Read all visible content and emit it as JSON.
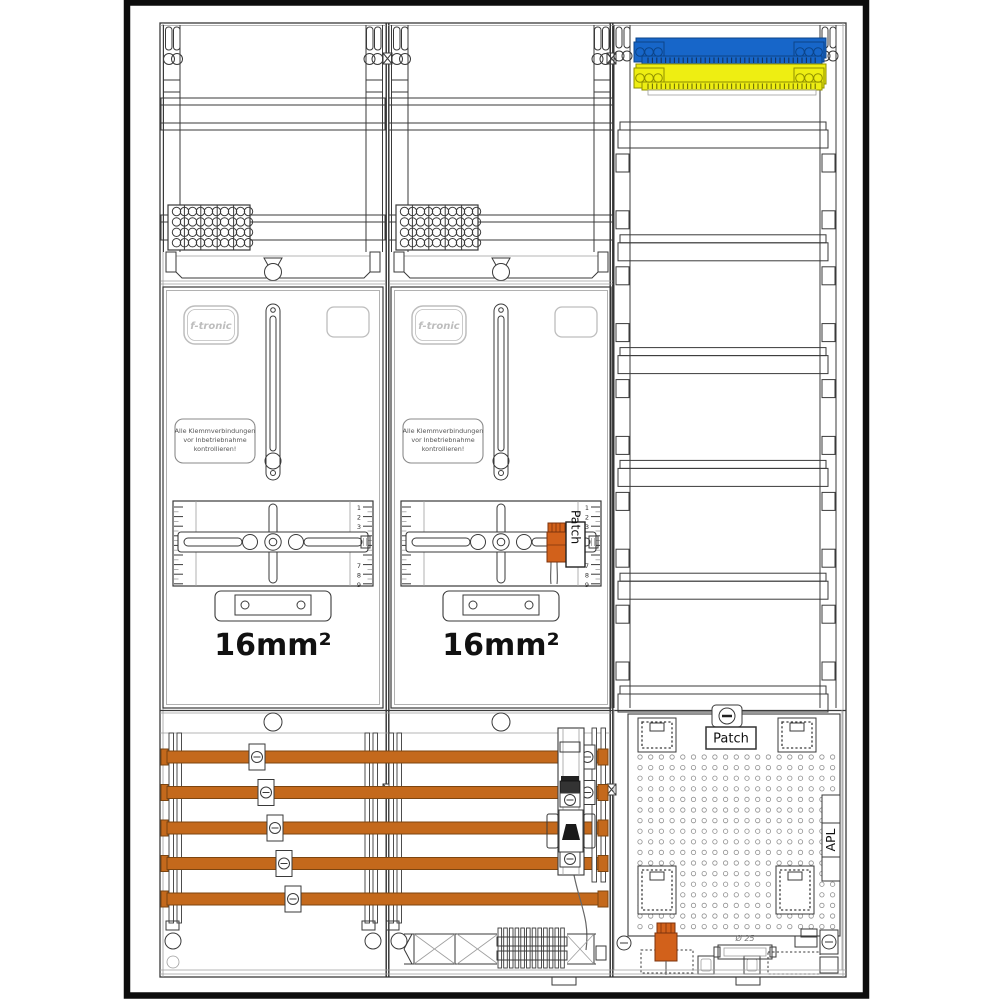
{
  "brand_label": "f-tronic",
  "warning_label": {
    "line1": "Alle Klemmverbindungen",
    "line2": "vor Inbetriebnahme",
    "line3": "kontrollieren!"
  },
  "meter_field": {
    "cross_section_label": "16mm²",
    "ruler_numbers_top": [
      "1",
      "2",
      "3"
    ],
    "ruler_numbers_bottom": [
      "7",
      "8",
      "9"
    ]
  },
  "patch_module_label": "Patch",
  "apl_section": {
    "patch_label": "Patch",
    "apl_label": "APL",
    "conduit_diameter_label": "Ø 25"
  },
  "colors": {
    "line": "#3a3a3a",
    "line_light": "#9e9e9e",
    "frame": "#0d0d0d",
    "busbar": "#c4691c",
    "busbar_edge": "#7c4510",
    "neutral_blue": "#1766c9",
    "neutral_blue_edge": "#0c4488",
    "pe_yellow": "#eeee12",
    "pe_yellow_edge": "#8f8f00",
    "connector_orange": "#d2611b",
    "connector_edge": "#7c330c",
    "logo_gray": "#bdbdbd"
  },
  "counts": {
    "busbars": 5,
    "busbar_clamps": 5,
    "din_rows": 6,
    "perforation_cols": 19,
    "perforation_rows": 17,
    "terminal_block_segments": 5,
    "terminal_circle_cols": 10,
    "terminal_circle_rows": 4,
    "comb_teeth": 12,
    "bar_end_terminals": 3,
    "ruler_major_ticks": 9
  }
}
